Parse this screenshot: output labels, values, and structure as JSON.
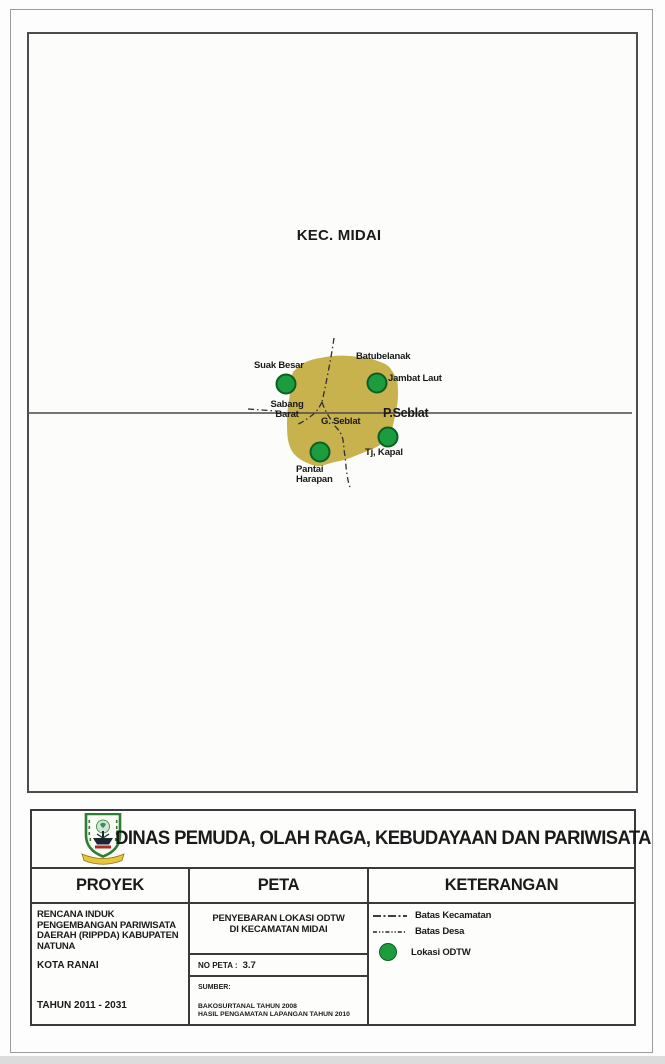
{
  "map": {
    "region_label": "KEC. MIDAI",
    "island_color": "#c8b24e",
    "marker_color": "#1d9c3d",
    "marker_border_color": "#0b5f26",
    "labels": {
      "suak_besar": "Suak Besar",
      "batubelanak": "Batubelanak",
      "jambat_laut": "Jambat Laut",
      "sabang_barat": "Sabang Barat",
      "g_seblat": "G. Seblat",
      "p_seblat": "P.Seblat",
      "tj_kapal": "Tj, Kapal",
      "pantai_harapan": "Pantai Harapan"
    }
  },
  "title_block": {
    "agency_title": "DINAS PEMUDA, OLAH RAGA, KEBUDAYAAN DAN PARIWISATA",
    "column_headers": {
      "proyek": "PROYEK",
      "peta": "PETA",
      "keterangan": "KETERANGAN"
    },
    "proyek": {
      "project_name": "RENCANA INDUK PENGEMBANGAN PARIWISATA DAERAH (RIPPDA) KABUPATEN NATUNA",
      "city": "KOTA RANAI",
      "period": "TAHUN 2011 - 2031"
    },
    "peta": {
      "map_title_line1": "PENYEBARAN LOKASI ODTW",
      "map_title_line2": "DI KECAMATAN MIDAI",
      "no_peta_label": "NO PETA :",
      "no_peta_value": "3.7",
      "sumber_label": "SUMBER:",
      "sumber_line1": "BAKOSURTANAL TAHUN 2008",
      "sumber_line2": "HASIL PENGAMATAN LAPANGAN TAHUN 2010"
    },
    "keterangan": {
      "items": [
        {
          "symbol": "dash-dot-line",
          "label": "Batas Kecamatan"
        },
        {
          "symbol": "fine-dash-dot-line",
          "label": "Batas Desa"
        },
        {
          "symbol": "green-circle",
          "label": "Lokasi ODTW"
        }
      ]
    }
  }
}
